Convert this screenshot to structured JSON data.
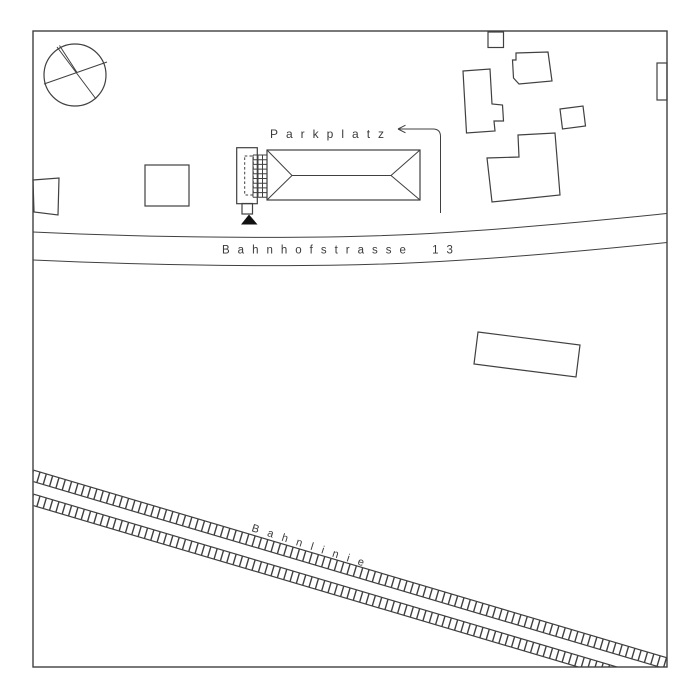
{
  "labels": {
    "parking": "Parkplatz",
    "street": "Bahnhofstrasse 13",
    "railway": "Bahnlinie"
  },
  "colors": {
    "background": "#ffffff",
    "line": "#404040",
    "text": "#3a3a3a",
    "marker_fill": "#111111"
  },
  "symbols": {
    "crossed_circle": "crossed-circle-survey-symbol",
    "entrance_marker": "filled-triangle-marker",
    "parking_arrow": "left-arrow-with-curved-leader",
    "railway_track": "ladder-track-symbol"
  }
}
